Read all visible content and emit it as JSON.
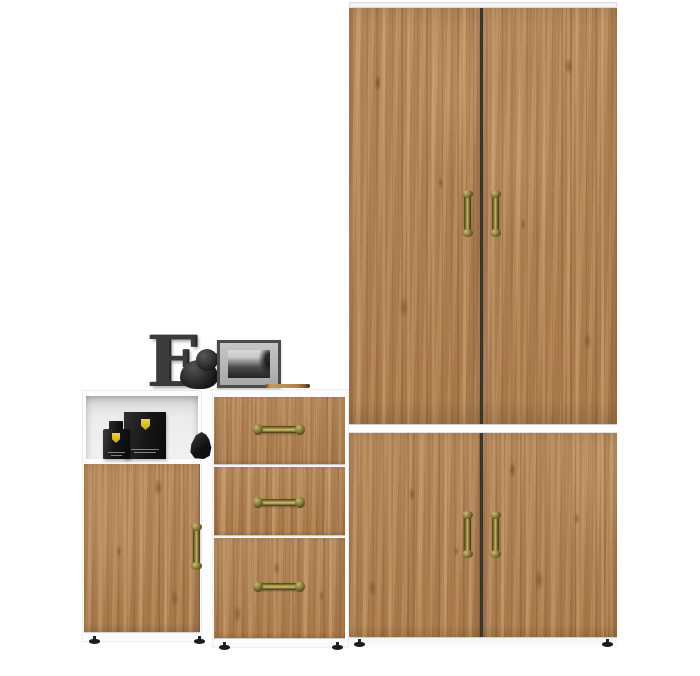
{
  "canvas": {
    "width": 700,
    "height": 676,
    "background": "#ffffff"
  },
  "furniture_set": {
    "wardrobe": {
      "name": "tall two-door wardrobe",
      "doors": 2,
      "handles": 2,
      "handle_finish": "antique brass, vertical"
    },
    "base_cabinet": {
      "name": "wide two-door base cabinet",
      "doors": 2,
      "handles": 2,
      "handle_finish": "antique brass, vertical"
    },
    "drawer_chest": {
      "name": "three-drawer chest",
      "drawers": 3,
      "handle_finish": "antique brass, horizontal"
    },
    "shelf_cabinet": {
      "name": "one-door cabinet with open niche",
      "doors": 1,
      "handles": 1,
      "handle_finish": "antique brass, vertical"
    }
  },
  "decor": {
    "letter": {
      "text": "E",
      "color": "#3b3b3b"
    },
    "elephant": {
      "name": "black elephant figurine",
      "color": "#1f1f1f"
    },
    "photo_frame": {
      "name": "dark frame with black-and-white seascape photo",
      "frame_color": "#4b4b4b"
    },
    "pencil": {
      "name": "wooden pencil",
      "color": "#b5814a"
    },
    "niche_items": {
      "perfume_box": {
        "name": "black box with yellow shield logo",
        "color": "#161616"
      },
      "perfume_bottle": {
        "name": "black bottle with yellow shield logo",
        "color": "#141414"
      },
      "figurine": {
        "name": "small black figurine",
        "color": "#141414"
      }
    }
  },
  "palette": {
    "wood": "#b78553",
    "wood_dark": "#7a4d28",
    "wood_light": "#d7ae7b",
    "carcass_white": "#fcfcfc",
    "door_divider": "#3a3129",
    "handle_brass": "#a5944a",
    "feet": "#1c1c1c",
    "shield_yellow": "#e8c81f"
  }
}
